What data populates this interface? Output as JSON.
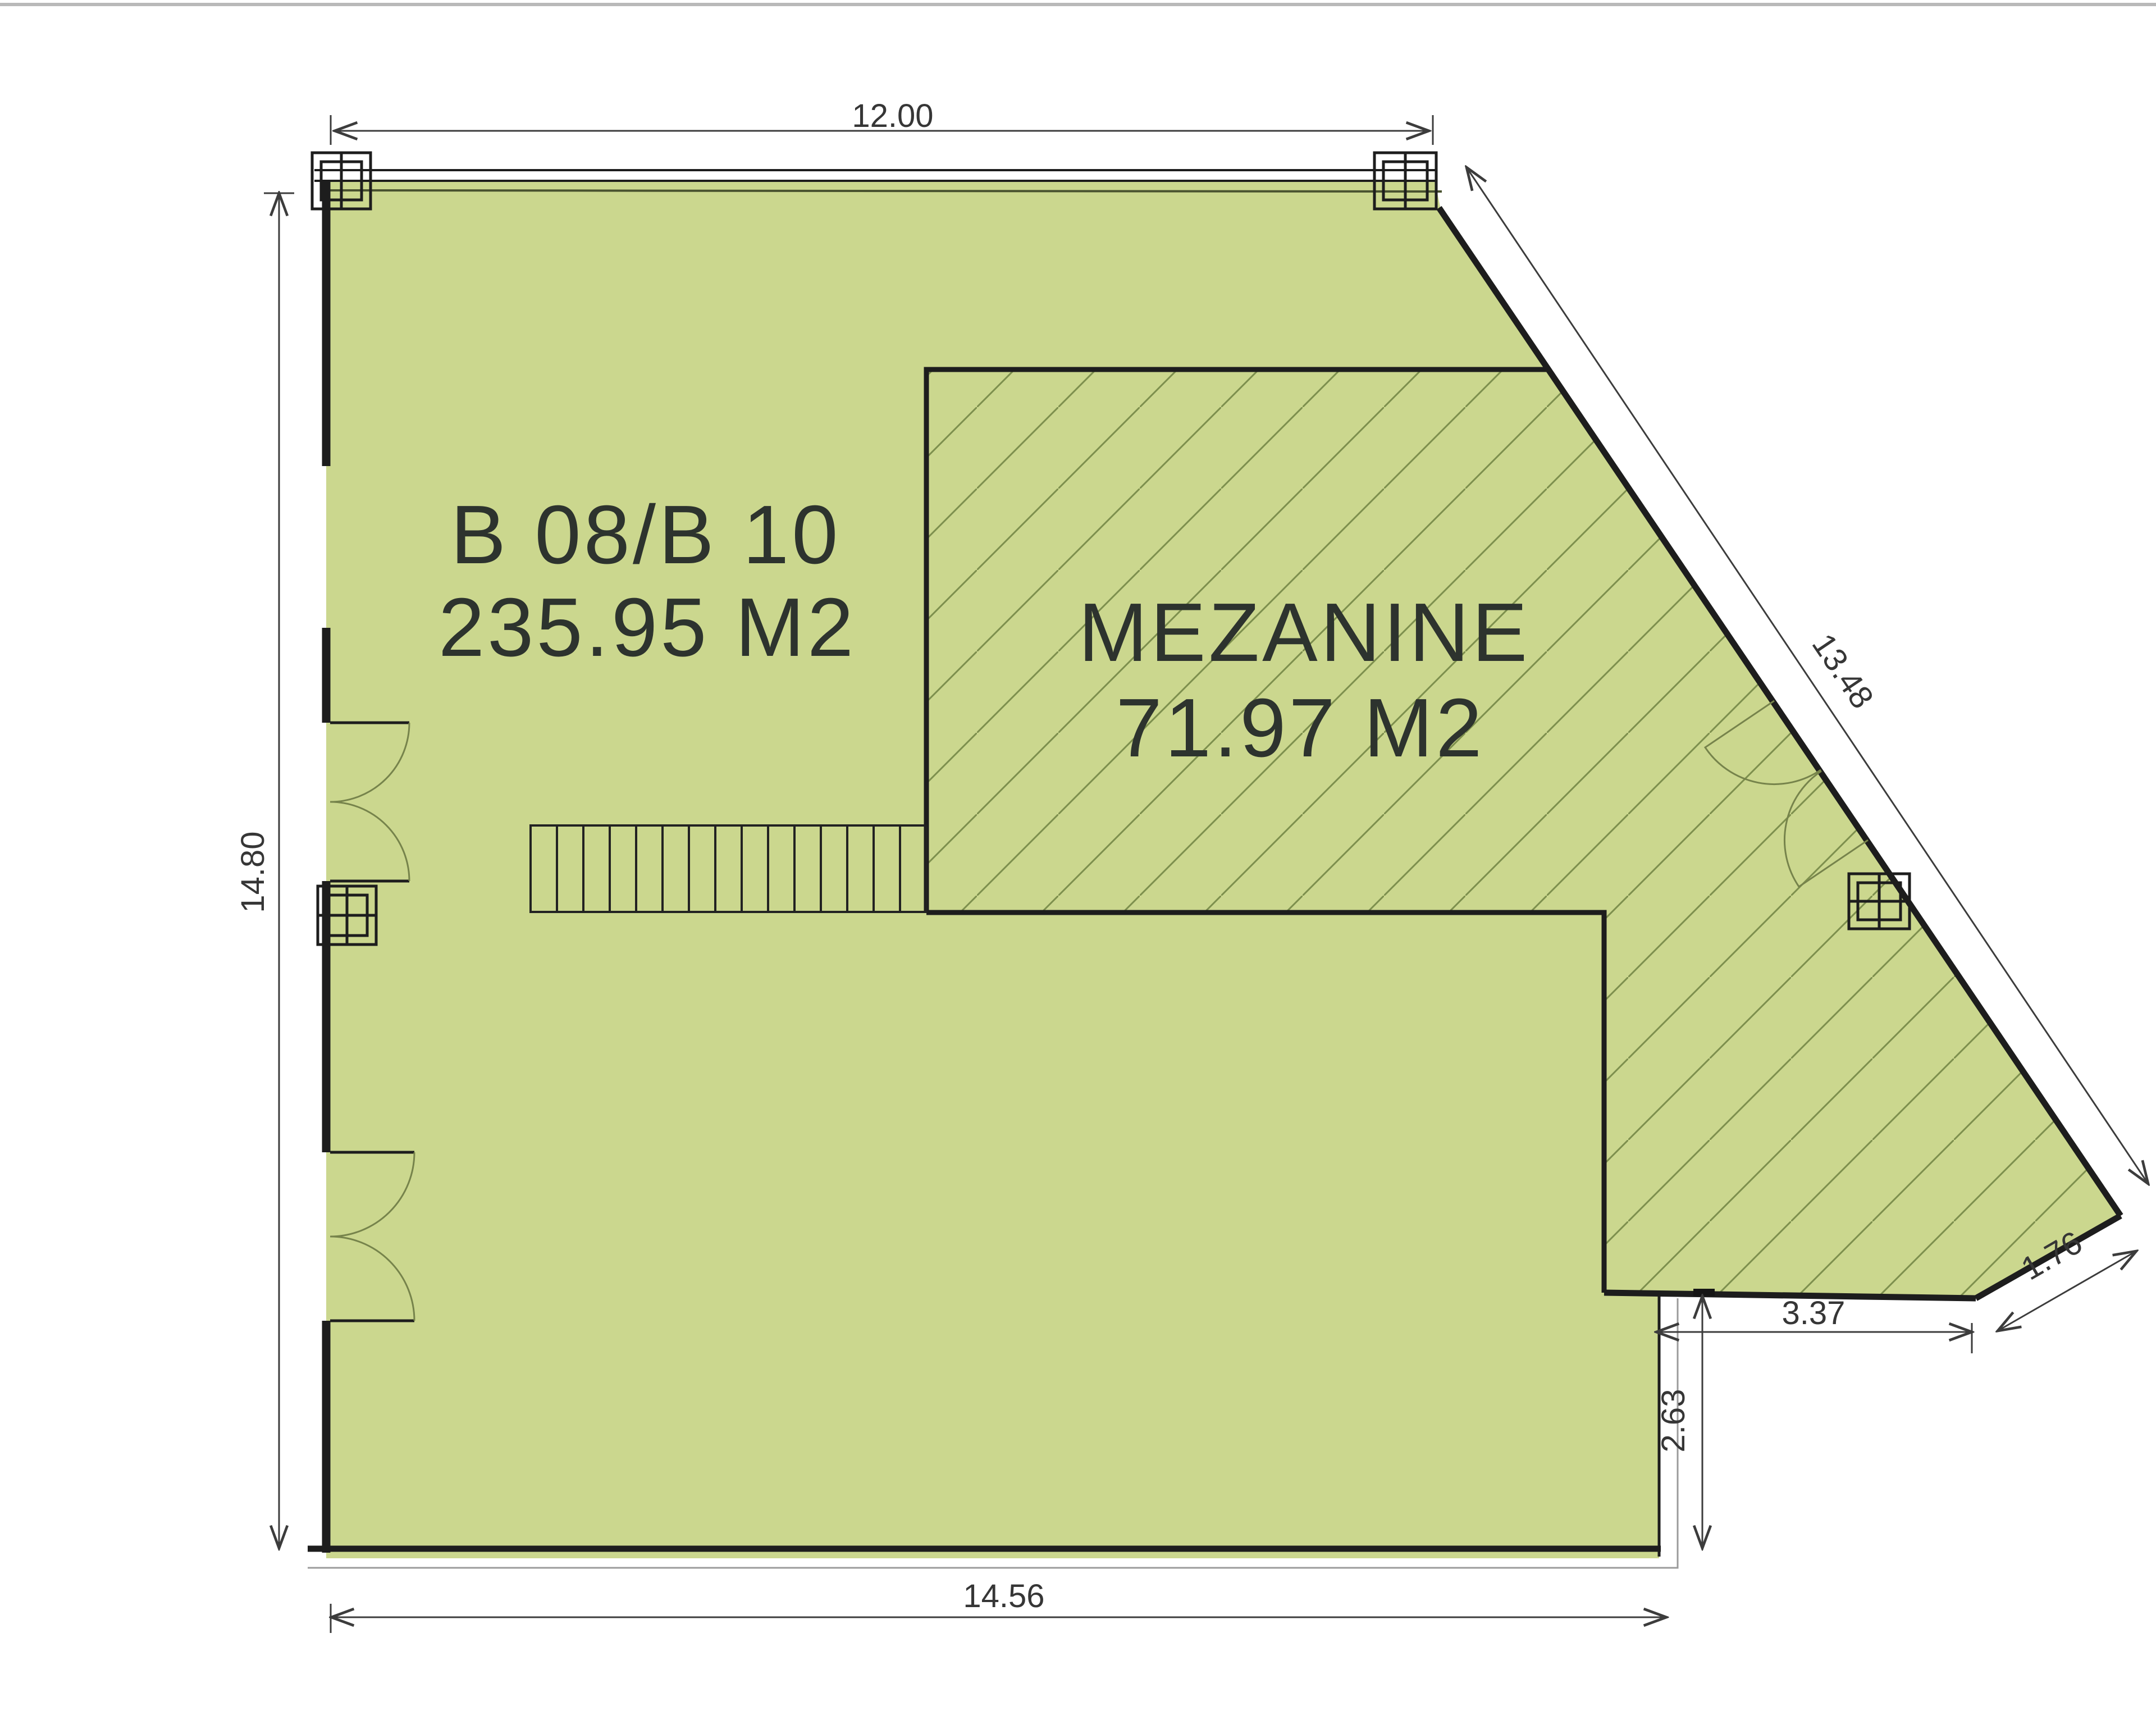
{
  "plan": {
    "unit_label": "B 08/B 10",
    "unit_area": "235.95 M2",
    "mezzanine_label": "MEZANINE",
    "mezzanine_area": "71.97 M2",
    "dimensions": {
      "top_width": "12.00",
      "left_height": "14.80",
      "diagonal": "13.48",
      "bottom_width": "14.56",
      "notch_width": "3.37",
      "notch_depth": "2.63",
      "corner_cut": "1.76"
    }
  },
  "colors": {
    "floor_fill": "#cbd78e",
    "hatch_line": "#7d8f4d",
    "outline": "#1d1d1d",
    "wall_dark": "#222222",
    "inner_edge": "#49522f",
    "door_arc": "#76834b",
    "offset_line": "#9b9b9b",
    "dimension": "#3c3c3c",
    "page_border": "#b9b9b9"
  }
}
